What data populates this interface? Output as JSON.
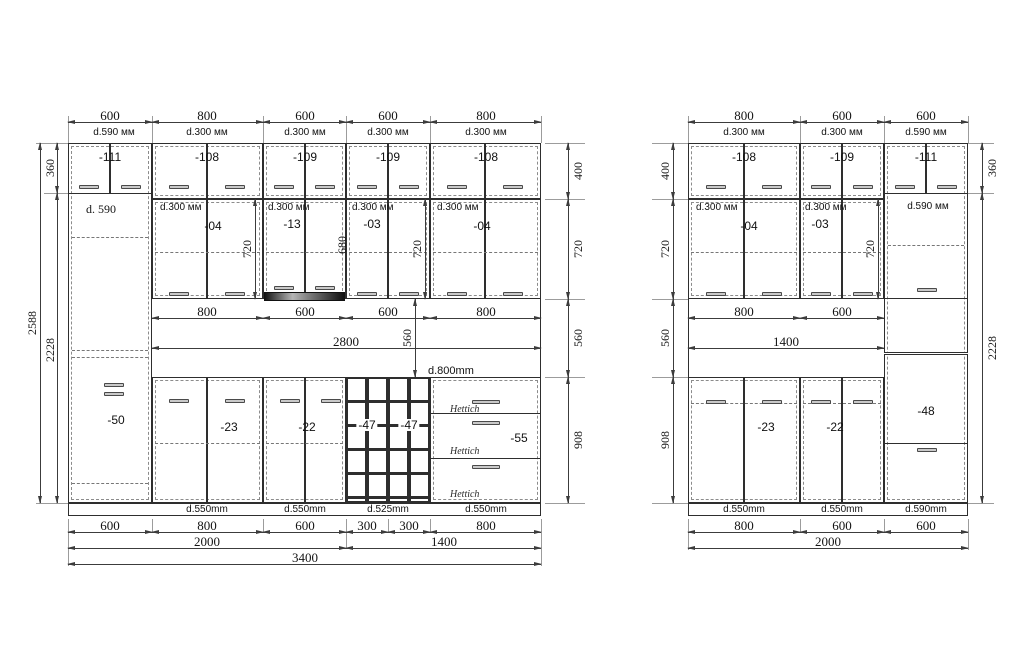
{
  "colors": {
    "line": "#2e2e2e",
    "dim_line": "#3c3c3c",
    "handle": "#c9c9c9",
    "plinth_red": "#bf7f7f",
    "background": "#ffffff"
  },
  "left": {
    "top_dims": [
      "600",
      "800",
      "600",
      "600",
      "800"
    ],
    "top_depths": [
      "d.590 мм",
      "d.300 мм",
      "d.300 мм",
      "d.300 мм",
      "d.300 мм"
    ],
    "row1_codes": [
      "-111",
      "-108",
      "-109",
      "-109",
      "-108"
    ],
    "row2_depths": [
      "d.300 мм",
      "d.300 мм",
      "d.300 мм",
      "d.300 мм"
    ],
    "row2_codes": [
      "-04",
      "-13",
      "-03",
      "-04"
    ],
    "row2_inner_dims": [
      "720",
      "680",
      "720"
    ],
    "tall": {
      "depth": "d. 590",
      "code": "-50"
    },
    "dims_left": {
      "total": "2588",
      "top": "360",
      "bottom": "2228"
    },
    "dims_right": [
      "400",
      "720",
      "560",
      "908"
    ],
    "mid_dims": [
      "800",
      "600",
      "600",
      "800"
    ],
    "mid_total": "2800",
    "mid_height": "560",
    "counter_depth": "d.800mm",
    "base_codes": [
      "-23",
      "-22",
      "-47",
      "-47",
      "-55"
    ],
    "drawer_brand": "Hettich",
    "bottom_depths": [
      "d.550mm",
      "d.550mm",
      "d.525mm",
      "d.550mm"
    ],
    "bottom_dims": [
      "600",
      "800",
      "600",
      "300",
      "300",
      "800"
    ],
    "bottom_groups": [
      "2000",
      "1400"
    ],
    "bottom_total": "3400"
  },
  "right": {
    "top_dims": [
      "800",
      "600",
      "600"
    ],
    "top_depths": [
      "d.300 мм",
      "d.300 мм",
      "d.590 мм"
    ],
    "row1_codes": [
      "-108",
      "-109",
      "-111"
    ],
    "row2_depths": [
      "d.300 мм",
      "d.300 мм"
    ],
    "row2_codes": [
      "-04",
      "-03"
    ],
    "row2_inner_dim": "720",
    "tall": {
      "depth": "d.590 мм",
      "code": "-48"
    },
    "dims_left": [
      "400",
      "720",
      "560",
      "908"
    ],
    "dims_right": {
      "top": "360",
      "bottom": "2228"
    },
    "mid_dims": [
      "800",
      "600"
    ],
    "mid_total": "1400",
    "base_codes": [
      "-23",
      "-22"
    ],
    "bottom_depths": [
      "d.550mm",
      "d.550mm",
      "d.590mm"
    ],
    "bottom_dims": [
      "800",
      "600",
      "600"
    ],
    "bottom_total": "2000"
  }
}
